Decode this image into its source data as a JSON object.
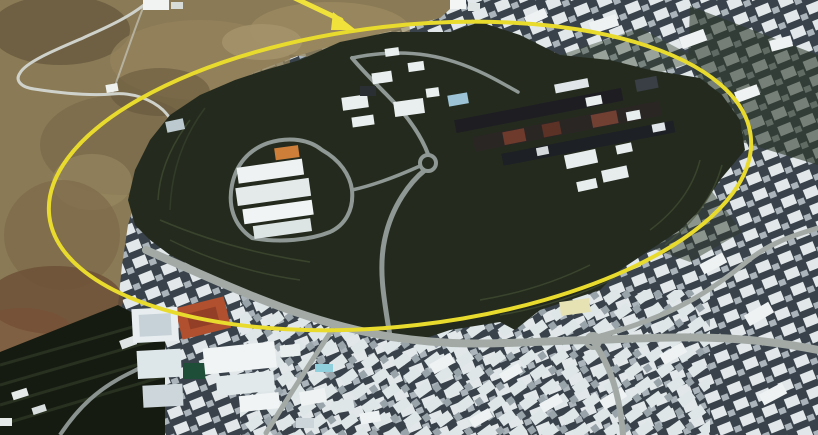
{
  "image": {
    "kind": "satellite-aerial-photograph",
    "annotation": {
      "highlight_color": "#e9da2e",
      "arrow_color": "#f0e23a"
    }
  },
  "palette": {
    "terrain": "#8a7a55",
    "terrain_shadow": "#64553c",
    "terrain_red": "#7a4e36",
    "vegetation": "#242b1e",
    "terrace_line": "#4a5538",
    "urban_base": "#39424a",
    "building_light": "#e2e8ea",
    "building_mid": "#a9b3b9",
    "road": "#a3aaa6",
    "mountain_road": "#cfd2cb",
    "track_red": "#b0502f",
    "roof_orange": "#cd7f3a",
    "roof_blue": "#9cc3d6",
    "pool_blue": "#8fd0dc",
    "field_green": "#1e4d38",
    "dark_slab": "#1e1e22",
    "slab_red": "#6e3a2c"
  }
}
